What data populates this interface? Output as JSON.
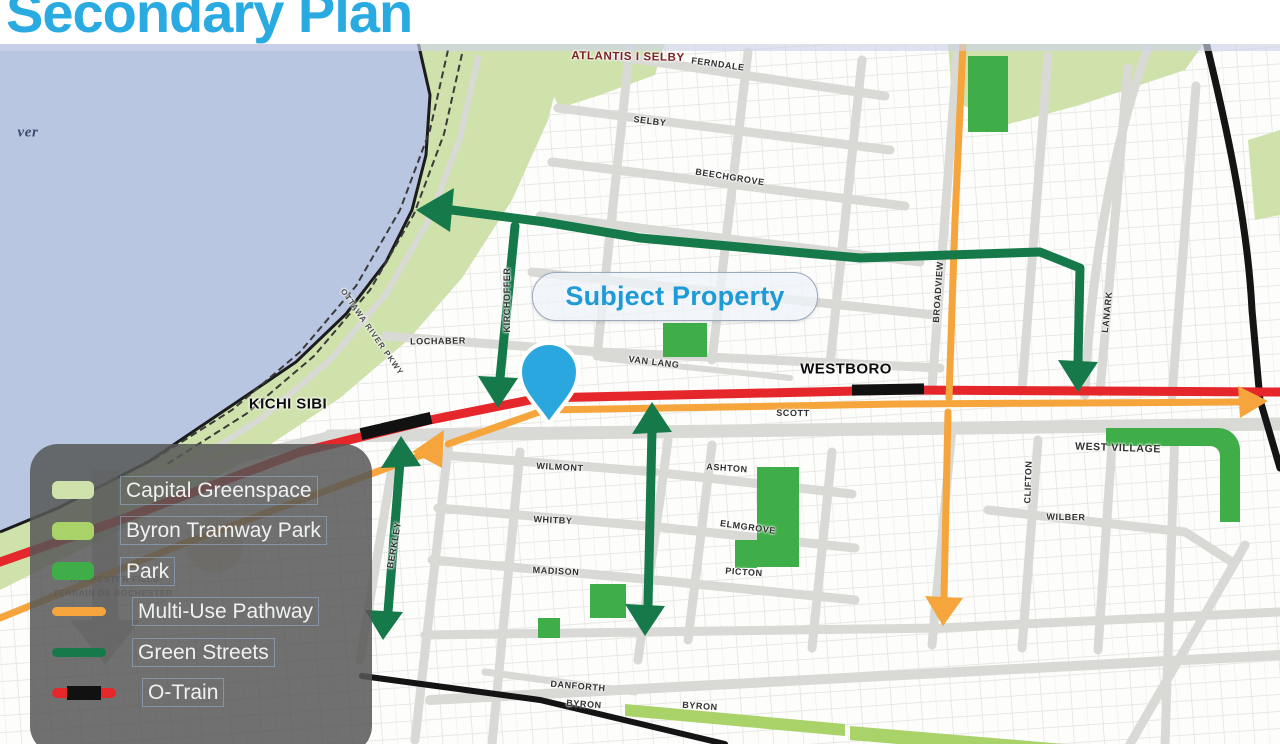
{
  "title": "Secondary Plan",
  "colors": {
    "title_blue": "#29abe2",
    "subject_property_blue": "#1e9ad6",
    "pin_blue": "#2aa7df",
    "water": "#b9c6e2",
    "capital_greenspace": "#cfe2ab",
    "byron_tramway_park": "#a9d268",
    "park": "#3fae49",
    "multi_use_pathway": "#f5a53c",
    "green_streets": "#15794a",
    "otrain_red": "#e5262b",
    "otrain_black": "#111111",
    "street_gray": "#d9d9d6",
    "legend_background": "#565756"
  },
  "map": {
    "river_label": "ver",
    "subject_property": "Subject Property",
    "station_labels": [
      "KICHI SIBI",
      "WESTBORO"
    ],
    "area_labels": {
      "atlantis_selby": "ATLANTIS I SELBY",
      "west_village": "WEST VILLAGE",
      "rochester_field": "ROCHESTER FIELD",
      "terrain_rochester": "TERRAIN DE ROCHESTER",
      "parkway": "OTTAWA RIVER PKWY"
    },
    "street_labels": [
      {
        "text": "FERNDALE"
      },
      {
        "text": "SELBY"
      },
      {
        "text": "BEECHGROVE"
      },
      {
        "text": "LOCHABER"
      },
      {
        "text": "VAN LANG"
      },
      {
        "text": "SCOTT"
      },
      {
        "text": "WILMONT"
      },
      {
        "text": "WHITBY"
      },
      {
        "text": "MADISON"
      },
      {
        "text": "ASHTON"
      },
      {
        "text": "ELMGROVE"
      },
      {
        "text": "PICTON"
      },
      {
        "text": "DANFORTH"
      },
      {
        "text": "BYRON"
      },
      {
        "text": "BYRON"
      },
      {
        "text": "WILBER"
      },
      {
        "text": "KIRCHOFFER"
      },
      {
        "text": "BROADVIEW"
      },
      {
        "text": "LANARK"
      },
      {
        "text": "CLIFTON"
      },
      {
        "text": "BERKLEY"
      }
    ]
  },
  "legend": {
    "items": [
      {
        "label": "Capital Greenspace",
        "swatch": "area",
        "color": "#cfe2ab"
      },
      {
        "label": "Byron Tramway Park",
        "swatch": "area",
        "color": "#a9d268"
      },
      {
        "label": "Park",
        "swatch": "area",
        "color": "#3fae49"
      },
      {
        "label": "Multi-Use Pathway",
        "swatch": "line",
        "color": "#f5a53c"
      },
      {
        "label": "Green Streets",
        "swatch": "line",
        "color": "#15794a"
      },
      {
        "label": "O-Train",
        "swatch": "rail",
        "color": "#e5262b",
        "color2": "#111111"
      }
    ]
  }
}
